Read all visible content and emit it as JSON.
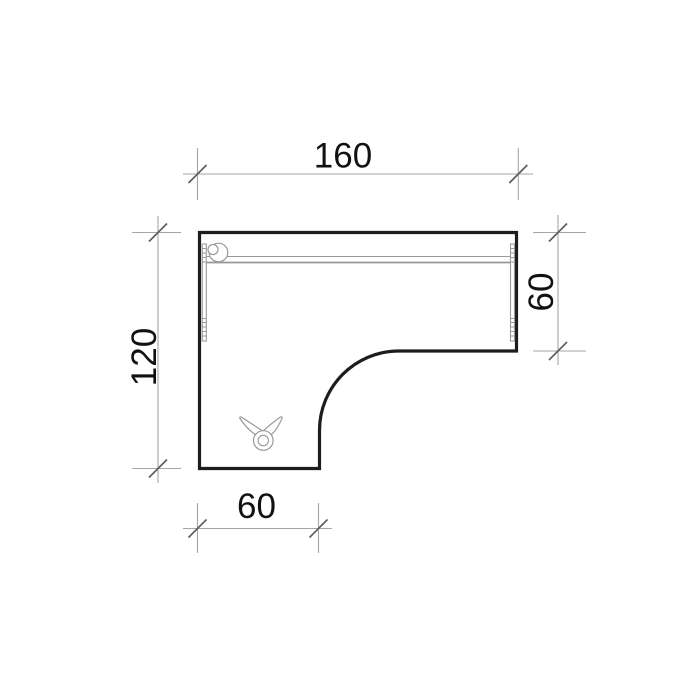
{
  "colors": {
    "background": "#ffffff",
    "outline": "#1d1d1d",
    "detail": "#999999",
    "dimline": "#a6a6a6",
    "tick": "#5f5f5f",
    "label": "#111111"
  },
  "drawing": {
    "dimensions": {
      "top": {
        "value": "160",
        "orientation": "horizontal"
      },
      "left": {
        "value": "120",
        "orientation": "vertical"
      },
      "right": {
        "value": "60",
        "orientation": "vertical"
      },
      "bottom": {
        "value": "60",
        "orientation": "horizontal"
      }
    },
    "icons": [
      {
        "name": "grommet-icon"
      },
      {
        "name": "cable-clamp-icon"
      }
    ]
  }
}
